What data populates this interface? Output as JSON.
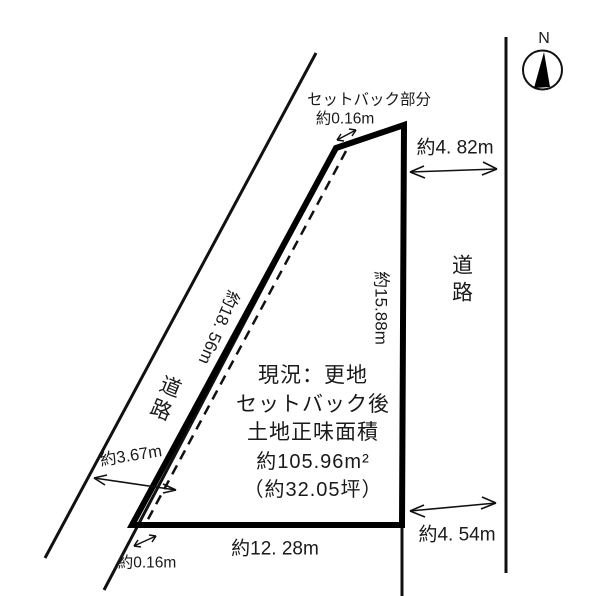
{
  "compass": {
    "north": "N"
  },
  "labels": {
    "setback_caption": "セットバック部分",
    "setback_top": "約0.16m",
    "setback_bottom": "約0.16m",
    "road_left": "道路",
    "road_right": "道路",
    "dim_top_right": "約4. 82m",
    "dim_left_edge": "約18. 56m",
    "dim_right_edge": "約15.88m",
    "dim_road_width": "約3.67m",
    "dim_bottom_edge": "約12. 28m",
    "dim_bottom_right": "約4. 54m"
  },
  "note": {
    "line1": "現況：更地",
    "line2": "セットバック後",
    "line3": "土地正味面積",
    "line4": "約105.96m²",
    "line5": "（約32.05坪）"
  },
  "colors": {
    "ink": "#111111",
    "background": "#ffffff"
  }
}
